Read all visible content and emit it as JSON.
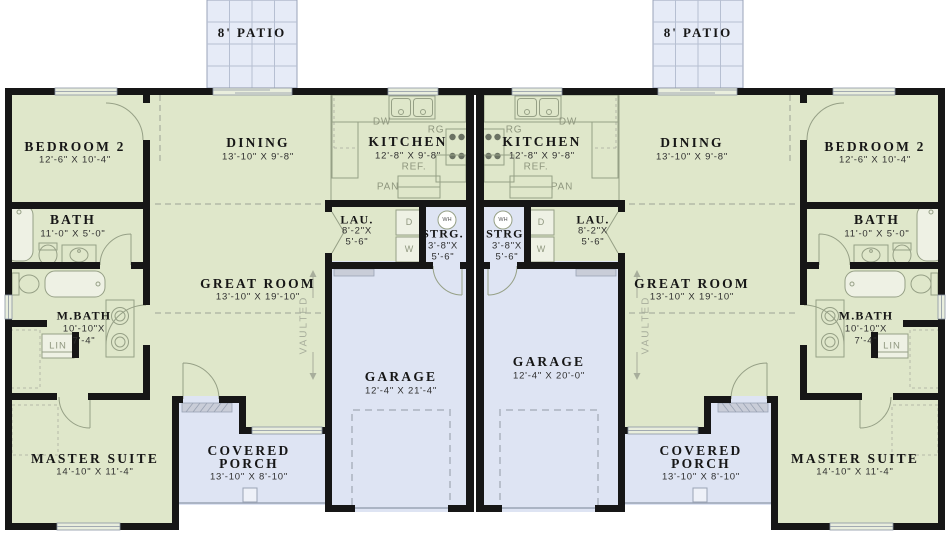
{
  "plan_type": "duplex-floor-plan",
  "patio_label": "8' PATIO",
  "colors": {
    "floor_green": "#dfe7ca",
    "floor_blue": "#dee4f3",
    "patio_blue": "#e6ebf7",
    "wall_black": "#161616",
    "fixture_gray": "#96a086"
  },
  "units": [
    {
      "side": "left",
      "bedroom2": {
        "name": "BEDROOM 2",
        "dims": "12'-6\" X 10'-4\""
      },
      "dining": {
        "name": "DINING",
        "dims": "13'-10\" X 9'-8\""
      },
      "kitchen": {
        "name": "KITCHEN",
        "dims": "12'-8\" X 9'-8\""
      },
      "bath": {
        "name": "BATH",
        "dims": "11'-0\" X 5'-0\""
      },
      "laundry": {
        "name": "LAU.",
        "dim1": "8'-2\"X",
        "dim2": "5'-6\""
      },
      "storage": {
        "name": "STRG.",
        "dim1": "3'-8\"X",
        "dim2": "5'-6\""
      },
      "great_room": {
        "name": "GREAT ROOM",
        "dims": "13'-10\" X 19'-10\""
      },
      "master_bath": {
        "name": "M.BATH",
        "dim1": "10'-10\"X",
        "dim2": "7'-4\""
      },
      "master_suite": {
        "name": "MASTER SUITE",
        "dims": "14'-10\" X 11'-4\""
      },
      "covered_porch": {
        "line1": "COVERED",
        "line2": "PORCH",
        "dims": "13'-10\" X 8'-10\""
      },
      "garage": {
        "name": "GARAGE",
        "dims": "12'-4\" X 21'-4\""
      },
      "vaulted_label": "VAULTED",
      "linen_label": "LIN",
      "appliances": {
        "dishwasher": "DW",
        "range": "RG",
        "refrigerator": "REF.",
        "pantry": "PAN",
        "dryer": "D",
        "washer": "W",
        "water_heater": "WH"
      }
    },
    {
      "side": "right",
      "bedroom2": {
        "name": "BEDROOM 2",
        "dims": "12'-6\" X 10'-4\""
      },
      "dining": {
        "name": "DINING",
        "dims": "13'-10\" X 9'-8\""
      },
      "kitchen": {
        "name": "KITCHEN",
        "dims": "12'-8\" X 9'-8\""
      },
      "bath": {
        "name": "BATH",
        "dims": "11'-0\" X 5'-0\""
      },
      "laundry": {
        "name": "LAU.",
        "dim1": "8'-2\"X",
        "dim2": "5'-6\""
      },
      "storage": {
        "name": "STRG.",
        "dim1": "3'-8\"X",
        "dim2": "5'-6\""
      },
      "great_room": {
        "name": "GREAT ROOM",
        "dims": "13'-10\" X 19'-10\""
      },
      "master_bath": {
        "name": "M.BATH",
        "dim1": "10'-10\"X",
        "dim2": "7'-4\""
      },
      "master_suite": {
        "name": "MASTER SUITE",
        "dims": "14'-10\" X 11'-4\""
      },
      "covered_porch": {
        "line1": "COVERED",
        "line2": "PORCH",
        "dims": "13'-10\" X 8'-10\""
      },
      "garage": {
        "name": "GARAGE",
        "dims": "12'-4\" X 20'-0\""
      },
      "vaulted_label": "VAULTED",
      "linen_label": "LIN",
      "appliances": {
        "dishwasher": "DW",
        "range": "RG",
        "refrigerator": "REF.",
        "pantry": "PAN",
        "dryer": "D",
        "washer": "W",
        "water_heater": "WH"
      }
    }
  ]
}
